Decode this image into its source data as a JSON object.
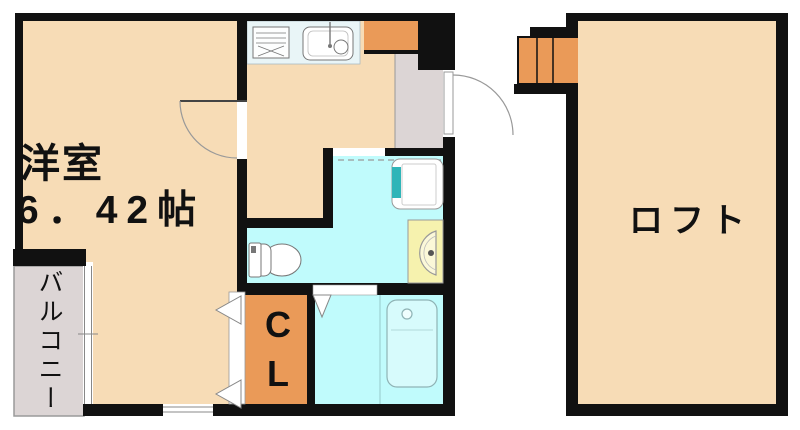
{
  "plan": {
    "title": "apartment-floor-plan",
    "rooms": {
      "western_room": {
        "name": "洋室",
        "size": "6．42帖"
      },
      "balcony": {
        "name": "バルコニー"
      },
      "closet": {
        "label": "CL"
      },
      "loft": {
        "name": "ロフト"
      }
    },
    "fixtures": [
      "stove",
      "kitchen-sink",
      "toilet",
      "washing-machine-pan",
      "wash-basin",
      "bathtub",
      "stairs",
      "entry-door",
      "room-door"
    ],
    "colors": {
      "room_fill": "#f7dcb6",
      "wet_area_fill": "#c0fbfc",
      "accent_orange": "#ea9a58",
      "gray_floor": "#dcd5d5",
      "counter": "#e9f5f7",
      "basin_yellow": "#f6f2ae",
      "tub_fill": "#d7fbfc",
      "wall": "#111111"
    }
  }
}
